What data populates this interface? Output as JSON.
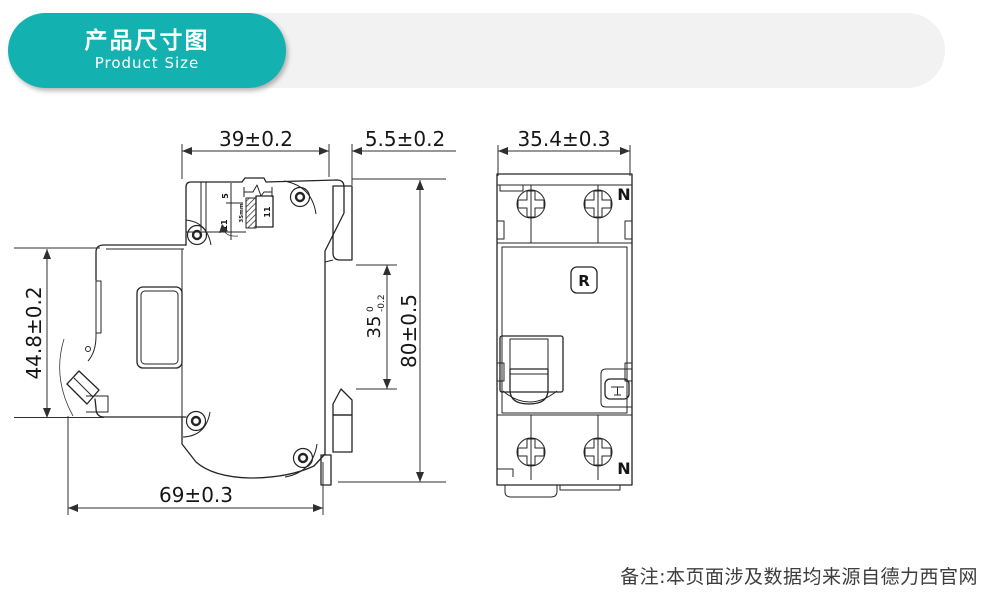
{
  "header": {
    "title": "产品尺寸图",
    "subtitle": "Product Size",
    "badge_color": "#14b1b1",
    "bar_color": "#f2f2f2"
  },
  "side_view": {
    "dim_top_width": "39±0.2",
    "dim_rail_depth": "5.5±0.2",
    "dim_front_height": "44.8±0.2",
    "dim_rail_span": {
      "value": "35",
      "upper_tol": "0",
      "lower_tol": "-0.2"
    },
    "dim_total_height": "80±0.5",
    "dim_total_depth": "69±0.3",
    "inset": {
      "label_top": "5",
      "label_left": "11",
      "label_right": "11",
      "rail_text": "35mm"
    }
  },
  "front_view": {
    "dim_width": "35.4±0.3",
    "terminal_top": "N",
    "terminal_bottom": "N",
    "reset_button": "R"
  },
  "footer": {
    "note": "备注:本页面涉及数据均来源自德力西官网"
  }
}
